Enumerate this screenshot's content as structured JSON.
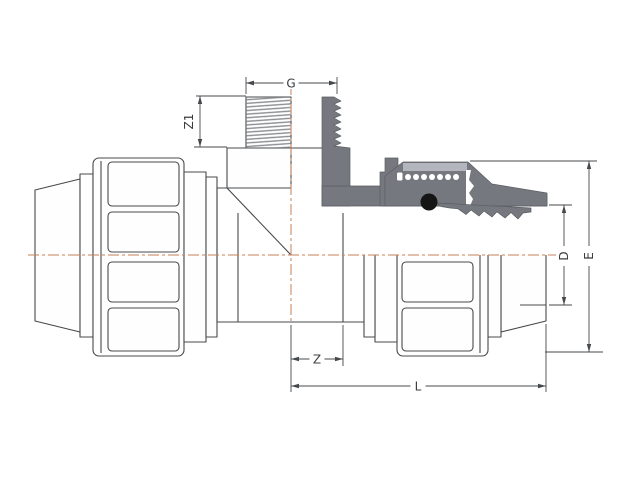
{
  "drawing": {
    "dims": {
      "g": "G",
      "z1": "Z1",
      "e": "E",
      "d": "D",
      "z": "Z",
      "l": "L"
    },
    "colors": {
      "outline": "#46494c",
      "section_fill": "#75797f",
      "section_highlight": "#b3b7bd",
      "centerline": "#c4805c",
      "o_ring": "#151515",
      "background": "#ffffff"
    }
  }
}
